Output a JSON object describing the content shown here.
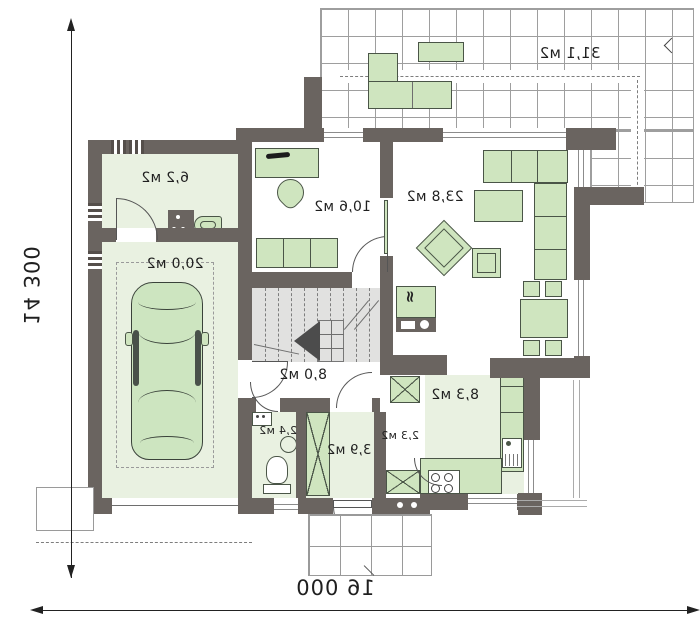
{
  "plan": {
    "type": "floor-plan",
    "mirrored_text": true,
    "dims": {
      "left": "14 300",
      "bottom": "16 000"
    },
    "rooms": [
      {
        "id": "terrace",
        "area": "31,1 м2"
      },
      {
        "id": "vestibule",
        "area": "6,2 м2"
      },
      {
        "id": "garage",
        "area": "20,0 м2"
      },
      {
        "id": "office",
        "area": "10,6 м2"
      },
      {
        "id": "living-room",
        "area": "23,8 м2"
      },
      {
        "id": "stair-hall",
        "area": "8,0 м2"
      },
      {
        "id": "wc",
        "area": "2,4 м2"
      },
      {
        "id": "entry-hall",
        "area": "3,9 м2"
      },
      {
        "id": "corridor",
        "area": "2,3 м2"
      },
      {
        "id": "kitchen",
        "area": "8,3 м2"
      }
    ],
    "icons": {
      "fireplace_glyph": "≈",
      "names": [
        "fireplace-icon",
        "stairs-direction-arrow-icon",
        "terrace-edge-arrow-icon",
        "dimension-arrow-icon"
      ]
    },
    "colors": {
      "wall": "#6a6460",
      "room_fill": "#e9f1e1",
      "furniture_fill": "#cfe5bf",
      "furniture_border": "#4a5547",
      "stairs_fill": "#e1e1e0",
      "grid_line": "#9e9e9e",
      "text": "#1f1f1f"
    }
  }
}
